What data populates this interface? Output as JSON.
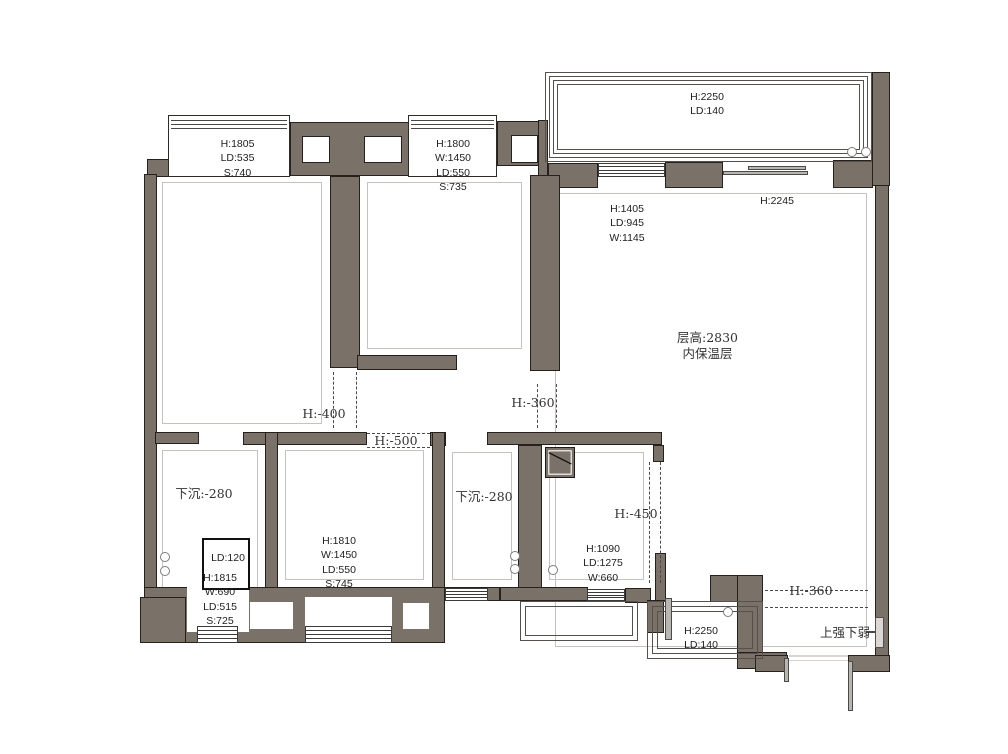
{
  "meta": {
    "width": 1008,
    "height": 754,
    "kind": "residential floor plan"
  },
  "colors": {
    "wall_fill": "#7a7169",
    "wall_outline": "#26211d",
    "window_line": "#3a3a3a",
    "inner_outline": "#c6c2be",
    "dash": "#4a4a4a",
    "text": "#1e1e1e",
    "background": "#ffffff"
  },
  "plan": {
    "walls": [
      [
        147,
        159,
        37,
        18
      ],
      [
        144,
        174,
        13,
        426
      ],
      [
        290,
        122,
        123,
        54
      ],
      [
        330,
        176,
        30,
        192
      ],
      [
        357,
        355,
        100,
        15
      ],
      [
        497,
        121,
        44,
        45
      ],
      [
        538,
        120,
        10,
        68
      ],
      [
        548,
        163,
        50,
        25
      ],
      [
        665,
        162,
        58,
        26
      ],
      [
        833,
        160,
        40,
        28
      ],
      [
        872,
        72,
        18,
        114
      ],
      [
        875,
        185,
        14,
        484
      ],
      [
        530,
        175,
        30,
        196
      ],
      [
        155,
        432,
        44,
        12
      ],
      [
        243,
        432,
        124,
        13
      ],
      [
        430,
        432,
        16,
        14
      ],
      [
        487,
        432,
        175,
        13
      ],
      [
        265,
        432,
        13,
        166
      ],
      [
        432,
        432,
        13,
        166
      ],
      [
        518,
        445,
        24,
        143
      ],
      [
        653,
        445,
        11,
        17
      ],
      [
        655,
        553,
        11,
        48
      ],
      [
        144,
        587,
        301,
        56
      ],
      [
        140,
        597,
        46,
        46
      ],
      [
        445,
        587,
        55,
        14
      ],
      [
        500,
        587,
        88,
        14
      ],
      [
        625,
        588,
        26,
        15
      ],
      [
        647,
        600,
        17,
        33
      ],
      [
        710,
        575,
        28,
        27
      ],
      [
        737,
        575,
        26,
        84
      ],
      [
        737,
        652,
        50,
        17
      ],
      [
        755,
        655,
        33,
        17
      ],
      [
        848,
        655,
        42,
        17
      ]
    ],
    "inner_outlines": [
      [
        162,
        182,
        160,
        242
      ],
      [
        367,
        182,
        155,
        167
      ],
      [
        555,
        193,
        312,
        454
      ],
      [
        285,
        450,
        139,
        130
      ],
      [
        452,
        452,
        60,
        128
      ],
      [
        549,
        452,
        95,
        128
      ],
      [
        162,
        450,
        96,
        140
      ]
    ],
    "niches": [
      [
        302,
        136,
        28,
        27
      ],
      [
        364,
        136,
        38,
        27
      ],
      [
        511,
        135,
        27,
        28
      ]
    ],
    "white_cuts": [
      [
        197,
        597,
        40,
        29
      ],
      [
        305,
        597,
        87,
        29
      ],
      [
        250,
        602,
        43,
        27
      ],
      [
        403,
        603,
        26,
        26
      ],
      [
        187,
        578,
        62,
        54
      ]
    ],
    "bay_windows": [
      [
        168,
        115,
        122,
        62
      ],
      [
        408,
        115,
        89,
        62
      ]
    ],
    "windows": [
      [
        598,
        163,
        67,
        14
      ],
      [
        445,
        588,
        43,
        13
      ],
      [
        587,
        589,
        38,
        12
      ],
      [
        197,
        626,
        41,
        17
      ],
      [
        305,
        626,
        87,
        17
      ]
    ],
    "railings": [
      {
        "x": 545,
        "y": 72,
        "w": 327,
        "h": 90,
        "count": 4,
        "inset": 4
      },
      {
        "x": 520,
        "y": 601,
        "w": 118,
        "h": 40,
        "count": 2,
        "inset": 5
      },
      {
        "x": 647,
        "y": 601,
        "w": 116,
        "h": 58,
        "count": 3,
        "inset": 5
      }
    ],
    "dashes": [
      {
        "x": 333,
        "y": 372,
        "len": 56,
        "dir": "v"
      },
      {
        "x": 356,
        "y": 372,
        "len": 56,
        "dir": "v"
      },
      {
        "x": 537,
        "y": 384,
        "len": 44,
        "dir": "v"
      },
      {
        "x": 556,
        "y": 384,
        "len": 44,
        "dir": "v"
      },
      {
        "x": 367,
        "y": 433,
        "len": 63,
        "dir": "h"
      },
      {
        "x": 367,
        "y": 447,
        "len": 63,
        "dir": "h"
      },
      {
        "x": 649,
        "y": 462,
        "len": 121,
        "dir": "v"
      },
      {
        "x": 660,
        "y": 462,
        "len": 121,
        "dir": "v"
      },
      {
        "x": 765,
        "y": 590,
        "len": 103,
        "dir": "h"
      },
      {
        "x": 765,
        "y": 607,
        "len": 103,
        "dir": "h"
      }
    ],
    "door_circles": [
      [
        852,
        152
      ],
      [
        866,
        152
      ],
      [
        165,
        557
      ],
      [
        165,
        571
      ],
      [
        515,
        556
      ],
      [
        515,
        569
      ],
      [
        553,
        570
      ],
      [
        728,
        612
      ]
    ],
    "door_bars": [
      [
        723,
        171,
        85,
        4
      ],
      [
        748,
        166,
        58,
        4
      ],
      [
        665,
        598,
        7,
        42
      ],
      [
        784,
        658,
        5,
        24
      ],
      [
        848,
        661,
        5,
        50
      ],
      [
        866,
        631,
        10,
        2
      ]
    ],
    "thresholds": [
      [
        789,
        655,
        59,
        2
      ],
      [
        789,
        660,
        59,
        1
      ]
    ],
    "closet": [
      202,
      538,
      48,
      52
    ],
    "flue": [
      545,
      447,
      30,
      31
    ],
    "panel": [
      875,
      617,
      9,
      31
    ],
    "labels": [
      {
        "lines": [
          "H:1805",
          "LD:535",
          "S:740"
        ],
        "x": 185,
        "y": 137,
        "w": 105,
        "serif": false
      },
      {
        "lines": [
          "H:1800",
          "W:1450",
          "LD:550",
          "S:735"
        ],
        "x": 403,
        "y": 137,
        "w": 100,
        "serif": false
      },
      {
        "lines": [
          "H:2250",
          "LD:140"
        ],
        "x": 657,
        "y": 90,
        "w": 100,
        "serif": false
      },
      {
        "lines": [
          "H:1405",
          "LD:945",
          "W:1145"
        ],
        "x": 577,
        "y": 202,
        "w": 100,
        "serif": false
      },
      {
        "lines": [
          "H:2245"
        ],
        "x": 727,
        "y": 194,
        "w": 100,
        "serif": false
      },
      {
        "lines": [
          "层高:2830",
          "内保温层"
        ],
        "x": 650,
        "y": 330,
        "w": 115,
        "serif": true
      },
      {
        "lines": [
          "H:-400"
        ],
        "x": 288,
        "y": 406,
        "w": 72,
        "serif": true
      },
      {
        "lines": [
          "H:-360"
        ],
        "x": 498,
        "y": 395,
        "w": 70,
        "serif": true
      },
      {
        "lines": [
          "H:-500"
        ],
        "x": 360,
        "y": 433,
        "w": 72,
        "serif": true
      },
      {
        "lines": [
          "下沉:-280"
        ],
        "x": 148,
        "y": 486,
        "w": 112,
        "serif": true
      },
      {
        "lines": [
          "下沉:-280"
        ],
        "x": 428,
        "y": 489,
        "w": 112,
        "serif": true
      },
      {
        "lines": [
          "H:-450"
        ],
        "x": 600,
        "y": 506,
        "w": 72,
        "serif": true
      },
      {
        "lines": [
          "H:1090",
          "LD:1275",
          "W:660"
        ],
        "x": 562,
        "y": 542,
        "w": 82,
        "serif": false
      },
      {
        "lines": [
          "LD:120"
        ],
        "x": 196,
        "y": 551,
        "w": 64,
        "serif": false
      },
      {
        "lines": [
          "H:1815",
          "W:690",
          "LD:515",
          "S:725"
        ],
        "x": 180,
        "y": 571,
        "w": 80,
        "serif": false
      },
      {
        "lines": [
          "H:1810",
          "W:1450",
          "LD:550",
          "S:745"
        ],
        "x": 293,
        "y": 534,
        "w": 92,
        "serif": false
      },
      {
        "lines": [
          "H:2250",
          "LD:140"
        ],
        "x": 660,
        "y": 624,
        "w": 82,
        "serif": false
      },
      {
        "lines": [
          "H:-360"
        ],
        "x": 775,
        "y": 583,
        "w": 72,
        "serif": true
      },
      {
        "lines": [
          "上强下弱"
        ],
        "x": 816,
        "y": 625,
        "w": 58,
        "serif": true
      }
    ]
  }
}
